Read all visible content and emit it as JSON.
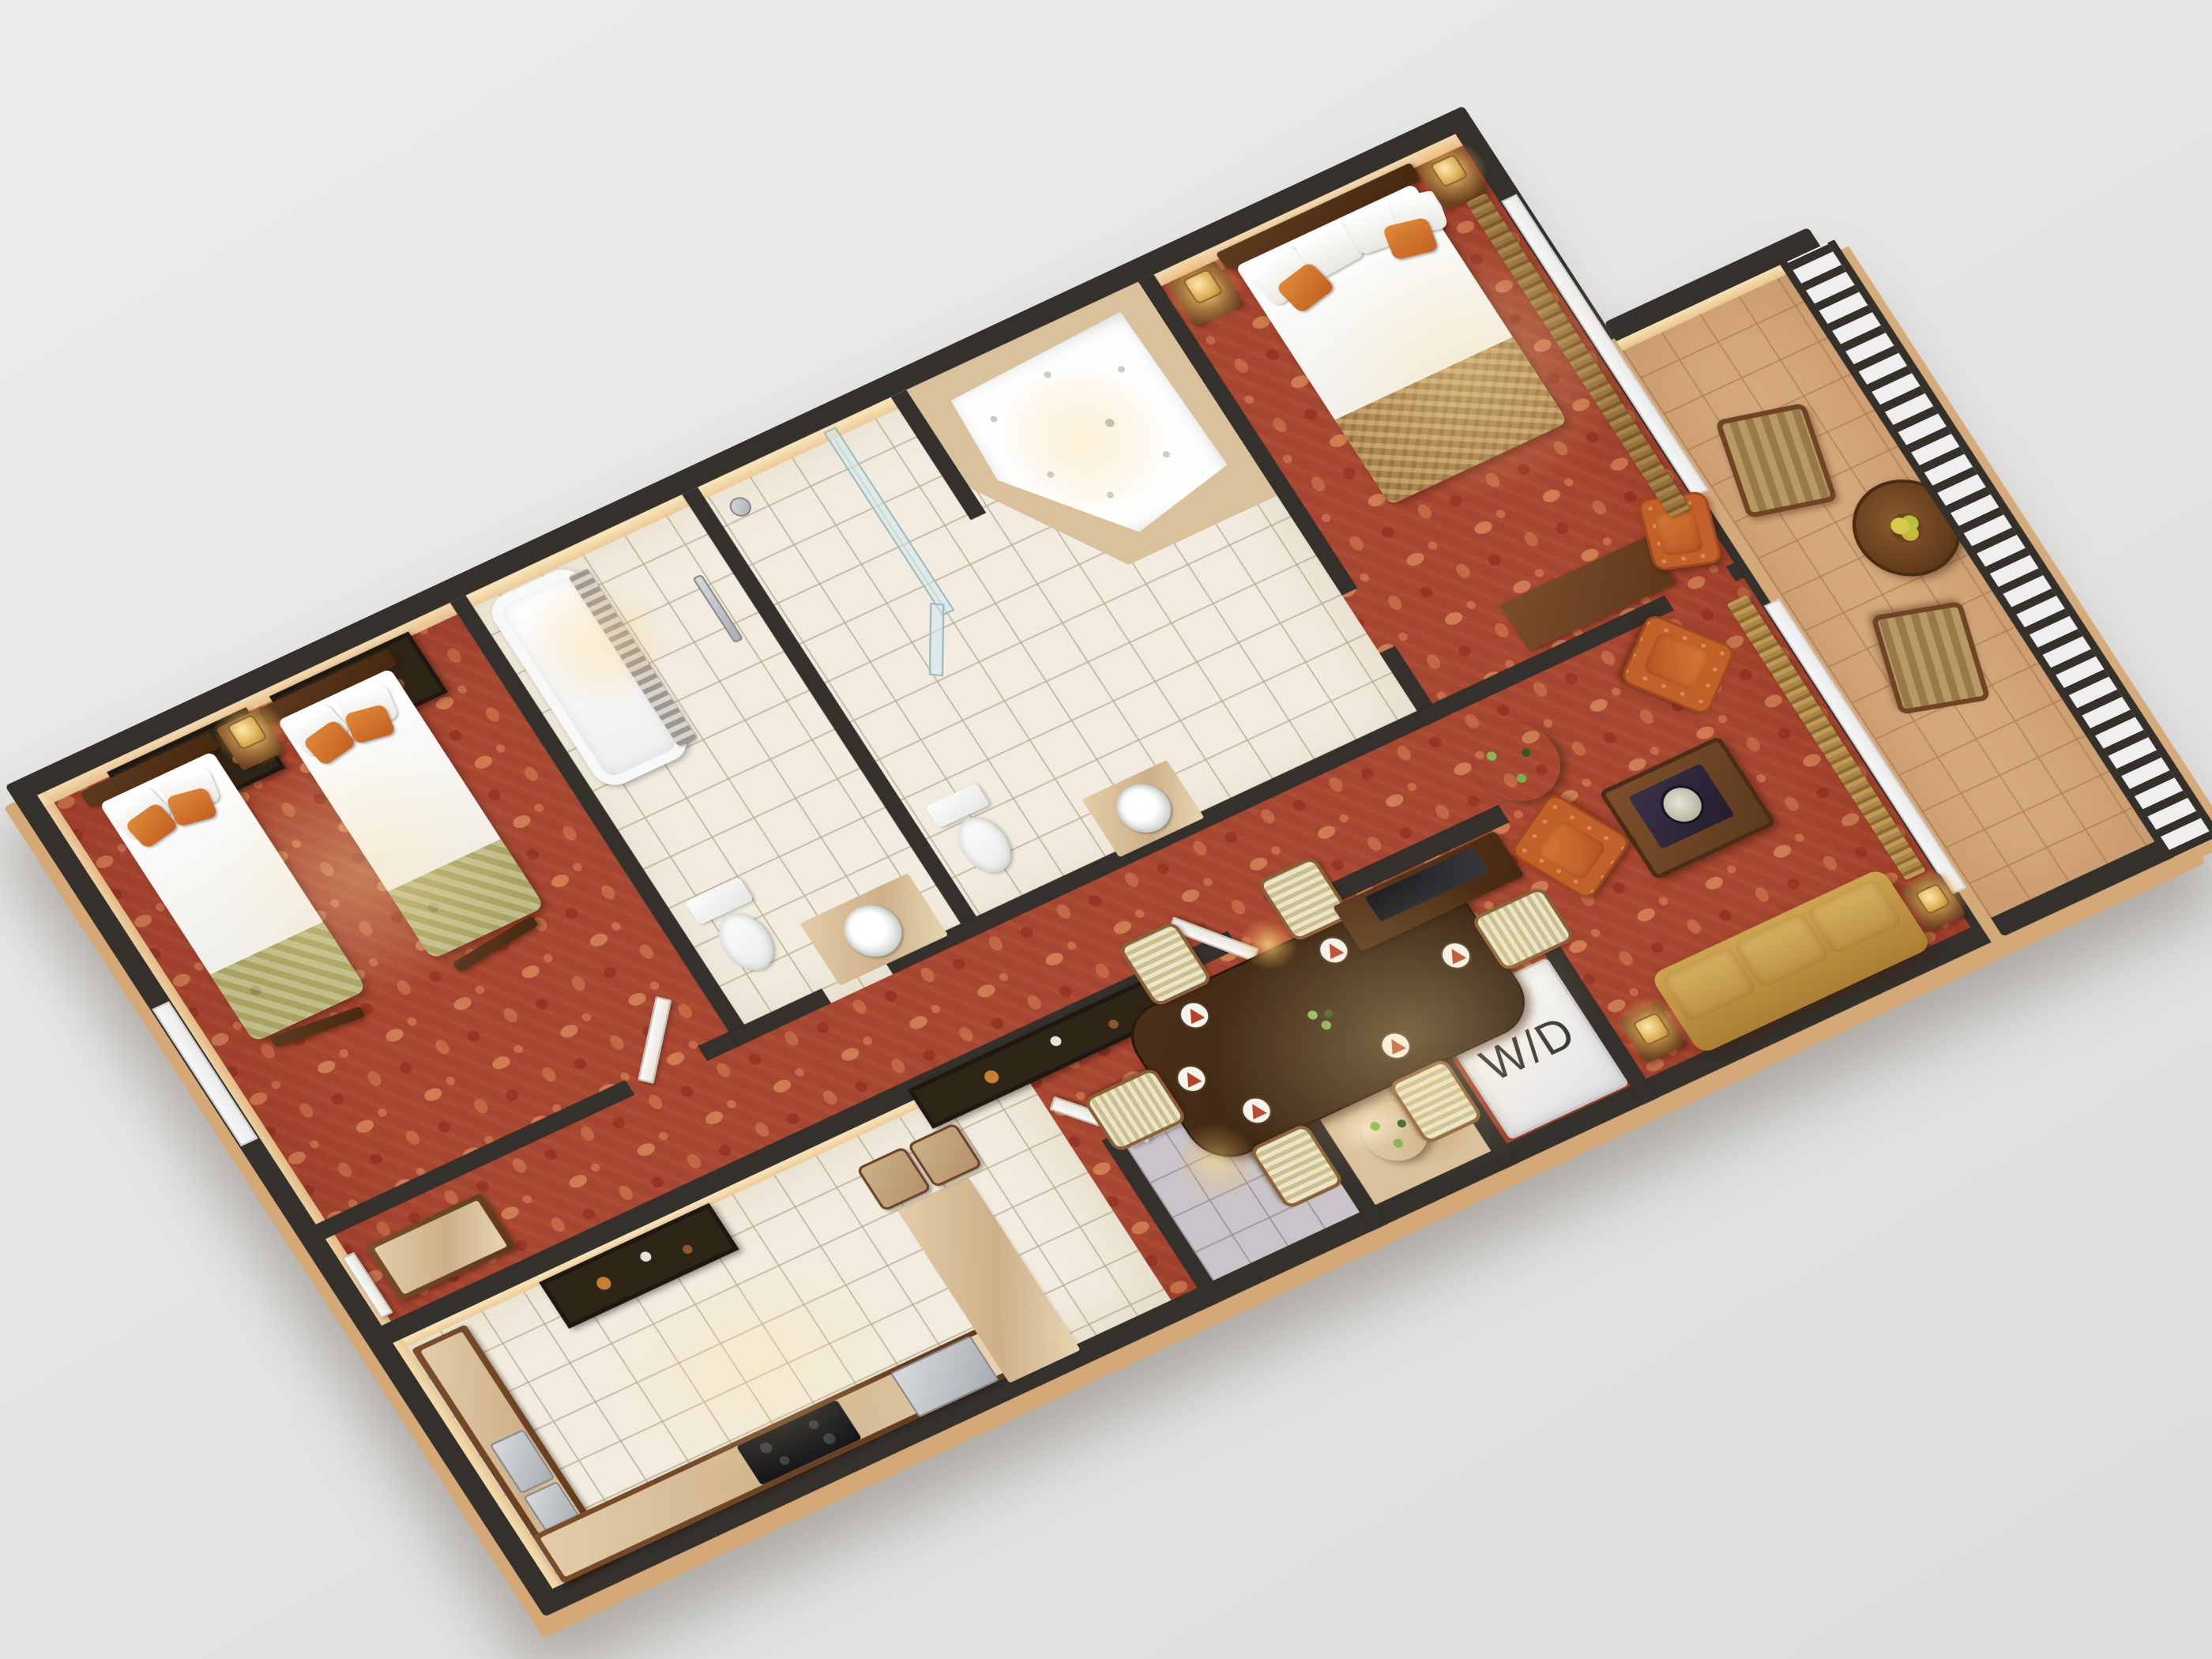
{
  "scene": {
    "type": "3d-floor-plan-rendering",
    "description": "Isometric 3D rendered floor plan of a two-bedroom, two-bath hotel suite with kitchen, dining area, living room, laundry closet and furnished balcony, rotated on a gray background",
    "rotation_deg": -25,
    "background_color": "#e6e6e6"
  },
  "labels": {
    "washer_dryer": "W/D"
  },
  "palette": {
    "wall": "#34302b",
    "wall_face": "#f2d9a8",
    "carpet": "#a64531",
    "carpet_pattern": "#d28a5c",
    "tile": "#f1ecdf",
    "foyer_tile": "#c8c4c9",
    "marble": "#d9c19c",
    "balcony_tile": "#d6a97c",
    "wood_dark": "#4a2d16",
    "wood_mid": "#7b4e2b",
    "sofa_gold": "#c89e4e",
    "armchair_orange": "#c2602a",
    "chair_cream": "#d8cfa0",
    "linen_white": "#fbfbf9",
    "blanket_green": "#a8a363",
    "blanket_gold": "#a8824a",
    "pillow_orange": "#d97c2e",
    "curtain_gold": "#b08948",
    "lamp_glow": "#ffd98a",
    "steel": "#b9bcc0",
    "exterior_edge": "#d5a977"
  },
  "rooms": [
    {
      "id": "bedroom-2",
      "name": "Second Bedroom",
      "floor": "red patterned carpet",
      "furniture": [
        "twin bed with white linens and green foot blanket x2",
        "orange and white pillows",
        "shared nightstand with lamp",
        "framed artwork x2",
        "luggage rack x2",
        "window",
        "open entry door"
      ]
    },
    {
      "id": "hall-bathroom",
      "name": "Hall Bathroom",
      "floor": "cream ceramic tile",
      "furniture": [
        "bathtub with gray shower curtain",
        "towel bar",
        "toilet",
        "round basin on marble vanity"
      ]
    },
    {
      "id": "master-bathroom",
      "name": "Master Bathroom",
      "floor": "cream ceramic tile",
      "furniture": [
        "glass walk-in shower",
        "corner whirlpool tub on marble deck",
        "toilet",
        "round basin on marble vanity"
      ]
    },
    {
      "id": "master-bedroom",
      "name": "Master Bedroom",
      "floor": "red patterned carpet",
      "furniture": [
        "king bed with gold foot blanket",
        "nightstand with lamp x2",
        "dresser",
        "orange armchair",
        "window wall with gold drapes"
      ]
    },
    {
      "id": "kitchen",
      "name": "Kitchen",
      "floor": "white tile",
      "furniture": [
        "L-shaped counter with double sink",
        "black cooktop",
        "stainless appliance",
        "breakfast-bar island",
        "bar stool x2",
        "framed artwork",
        "hall dresser"
      ]
    },
    {
      "id": "dining-area",
      "name": "Dining Area",
      "floor": "red patterned carpet",
      "furniture": [
        "rectangular dark-wood dining table",
        "striped dining chair x6",
        "place setting with red napkin x6",
        "centerpiece plant",
        "TV console with television",
        "framed artwork on partition",
        "potted plant"
      ]
    },
    {
      "id": "living-room",
      "name": "Living Room",
      "floor": "red patterned carpet",
      "furniture": [
        "gold three-seat sofa",
        "orange armchair x2",
        "wood coffee table with decorative tray",
        "side table with lamp x2",
        "gold drapes at balcony door"
      ]
    },
    {
      "id": "entry-foyer",
      "name": "Entry Foyer",
      "floor": "gray tile with marble vestibule",
      "furniture": [
        "suite entry door (open)",
        "potted plant"
      ]
    },
    {
      "id": "laundry-closet",
      "name": "Laundry Closet",
      "label_ref": "labels.washer_dryer",
      "furniture": [
        "stacked washer/dryer unit labeled W/D"
      ]
    },
    {
      "id": "balcony",
      "name": "Balcony",
      "floor": "terracotta tile",
      "furniture": [
        "striped armchair x2",
        "round wood table with fruit bowl",
        "white balustrade railing"
      ]
    }
  ]
}
